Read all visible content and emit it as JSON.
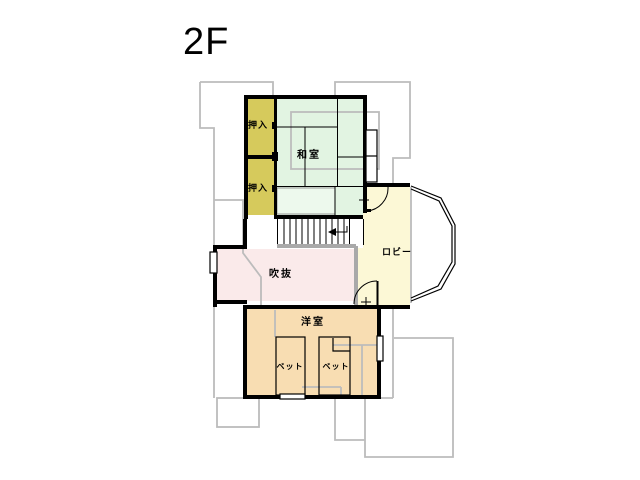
{
  "floor_label": "2F",
  "colors": {
    "wall": "#000000",
    "underlay": "#bcbcbc",
    "railing": "#a9a9a9",
    "closet": "#d6ca5c",
    "tatami_room": "#e2f4e2",
    "tatami_strip": "#edf9ed",
    "atrium": "#faeaea",
    "lobby": "#fcf8d6",
    "western_room": "#f8ddb2",
    "window": "#ffffff"
  },
  "rooms": {
    "oshiire_top": {
      "label": "押入"
    },
    "oshiire_bottom": {
      "label": "押入"
    },
    "washitsu": {
      "label": "和室"
    },
    "lobby": {
      "label": "ロビー"
    },
    "fukinuke": {
      "label": "吹抜"
    },
    "youshitsu": {
      "label": "洋室"
    },
    "bed_left": {
      "label": "ベット"
    },
    "bed_right": {
      "label": "ベット"
    }
  }
}
